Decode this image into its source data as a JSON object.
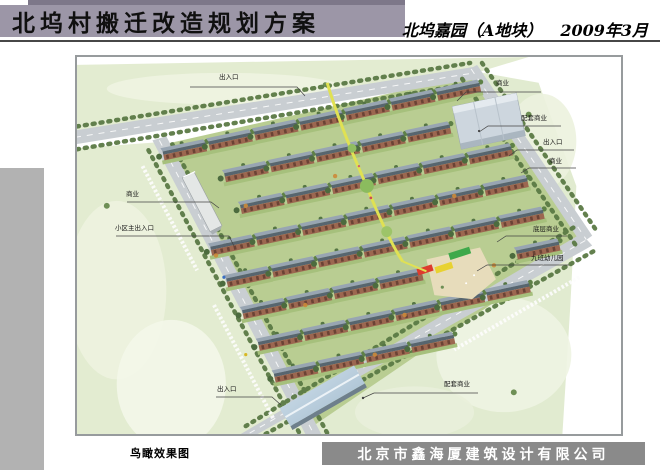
{
  "header": {
    "title": "北坞村搬迁改造规划方案",
    "project": "北坞嘉园（A地块）",
    "date": "2009年3月"
  },
  "footer": {
    "caption": "鸟瞰效果图",
    "company": "北京市鑫海厦建筑设计有限公司"
  },
  "annotations": [
    {
      "id": "entrance-top",
      "text": "出入口"
    },
    {
      "id": "commercial-left",
      "text": "商业"
    },
    {
      "id": "main-entrance-left",
      "text": "小区主出入口"
    },
    {
      "id": "commercial-right-top",
      "text": "商业"
    },
    {
      "id": "support-commercial-right",
      "text": "配套商业"
    },
    {
      "id": "entrance-right",
      "text": "出入口"
    },
    {
      "id": "commercial-right",
      "text": "商业"
    },
    {
      "id": "ground-floor-commercial",
      "text": "底层商业"
    },
    {
      "id": "kindergarten",
      "text": "九班幼儿园"
    },
    {
      "id": "support-commercial-bottom",
      "text": "配套商业"
    },
    {
      "id": "entrance-bottom-left",
      "text": "出入口"
    }
  ],
  "colors": {
    "title_bar": "#9c96a7",
    "title_bar_top": "#7d7789",
    "left_strip": "#b2b2b2",
    "company_bar": "#8a8a8a",
    "meadow": "#e3ecd1",
    "road": "#c9ced2",
    "site_green": "#b9cd92",
    "roof": "#98a5b2",
    "facade": "#9c6750",
    "tree": "#4c6b3e",
    "axis_yellow": "#e0e153",
    "kindergarten_red": "#dd3b2d",
    "kindergarten_yellow": "#e8d231",
    "kindergarten_green": "#3fa94b",
    "glass_building_blue": "#c0d3e2"
  }
}
